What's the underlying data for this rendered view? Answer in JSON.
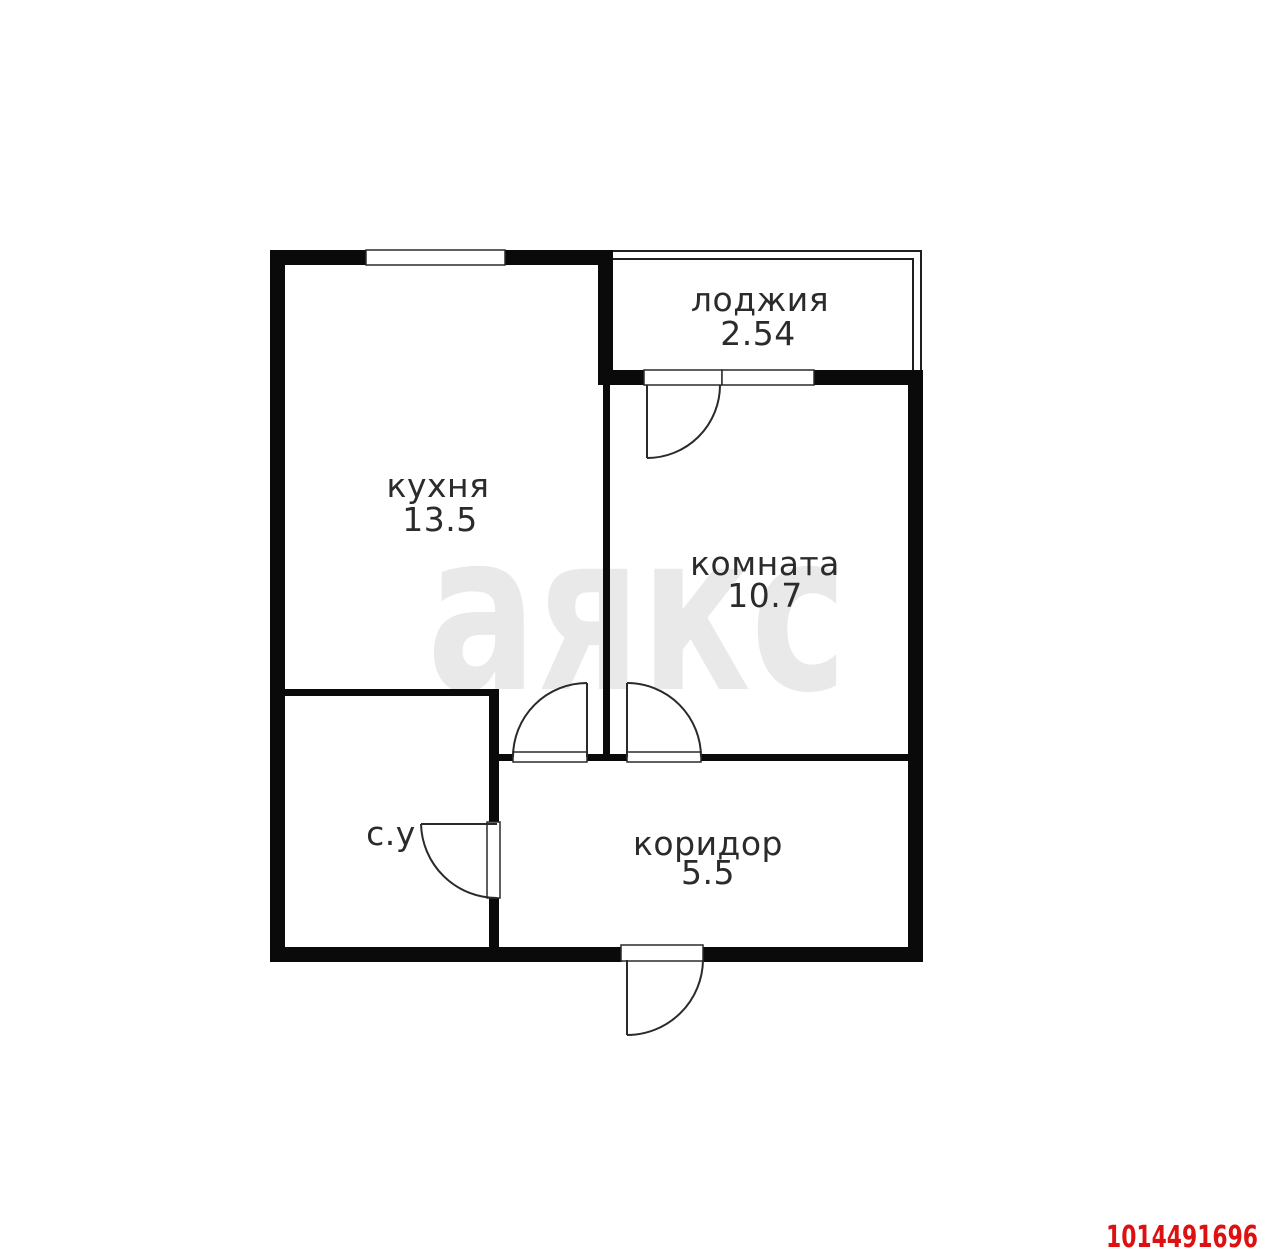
{
  "plan": {
    "rooms": [
      {
        "name": "loggia",
        "label": "лоджия",
        "area": "2.54"
      },
      {
        "name": "kitchen",
        "label": "кухня",
        "area": "13.5"
      },
      {
        "name": "room",
        "label": "комната",
        "area": "10.7"
      },
      {
        "name": "bathroom",
        "label": "с.у"
      },
      {
        "name": "corridor",
        "label": "коридор",
        "area": "5.5"
      }
    ],
    "watermark": "аякс",
    "listing_id": "1014491696",
    "colors": {
      "wall": "#0a0a0a",
      "door_line": "#2a2a2a",
      "watermark": "#e9e9e9",
      "listing_id": "#dd1111",
      "label_text": "#2b2b2b",
      "background": "#ffffff"
    }
  }
}
